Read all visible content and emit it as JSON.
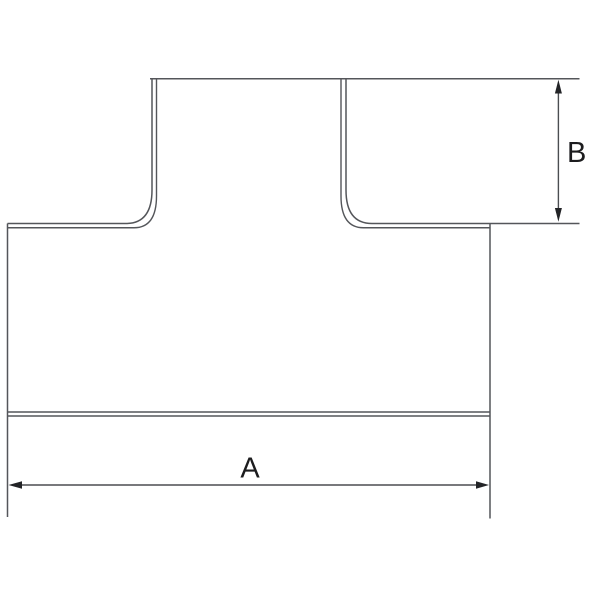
{
  "drawing": {
    "labels": {
      "dim_a": "A",
      "dim_b": "B"
    },
    "colors": {
      "background": "#ffffff",
      "outline": "#54565a",
      "dimension_line": "#4b4d51",
      "arrow": "#232427",
      "text": "#1c1c1e"
    }
  }
}
